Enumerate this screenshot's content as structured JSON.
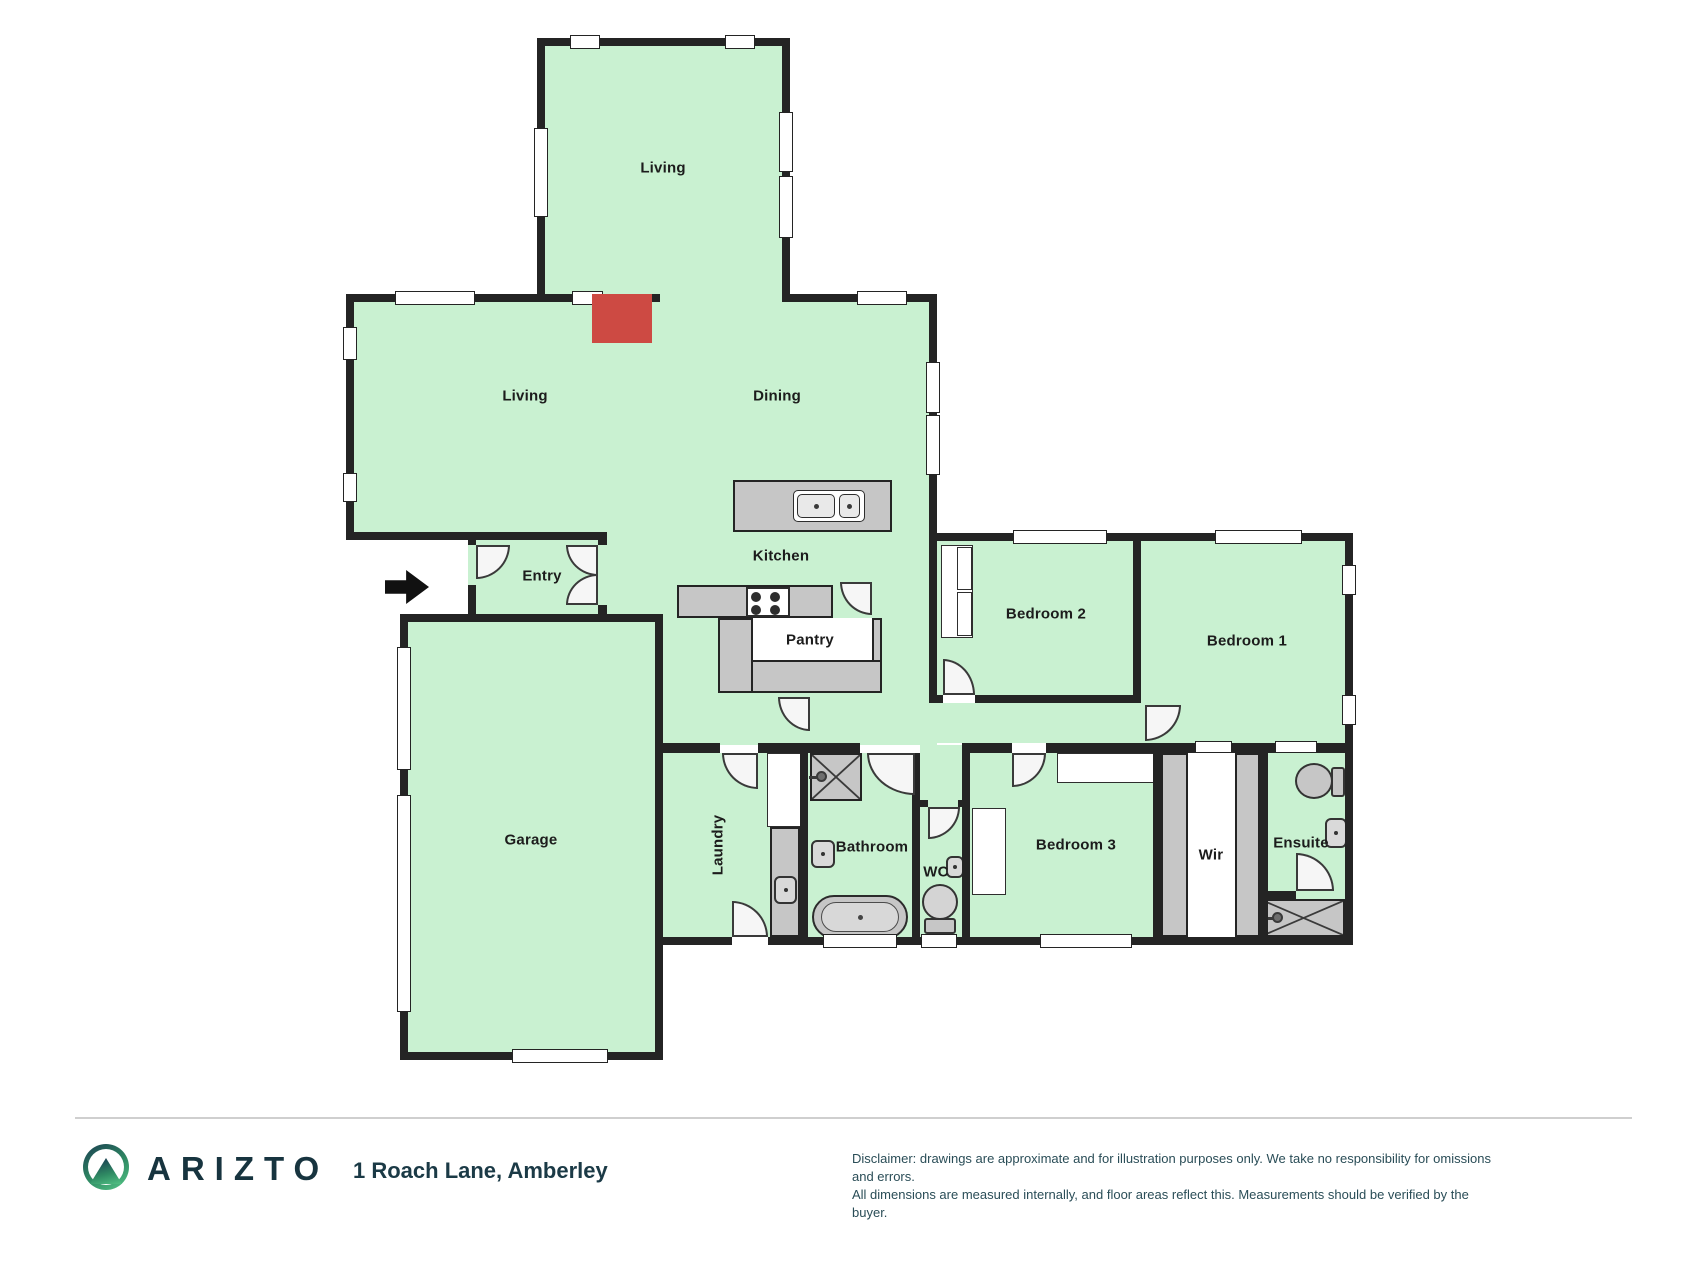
{
  "document": {
    "type": "floor-plan",
    "property_address": "1 Roach Lane, Amberley"
  },
  "floorplan": {
    "rooms": {
      "living_top": {
        "label": "Living"
      },
      "living": {
        "label": "Living"
      },
      "dining": {
        "label": "Dining"
      },
      "kitchen": {
        "label": "Kitchen"
      },
      "pantry": {
        "label": "Pantry"
      },
      "entry": {
        "label": "Entry"
      },
      "garage": {
        "label": "Garage"
      },
      "laundry": {
        "label": "Laundry"
      },
      "bathroom": {
        "label": "Bathroom"
      },
      "wc": {
        "label": "WC"
      },
      "bedroom1": {
        "label": "Bedroom 1"
      },
      "bedroom2": {
        "label": "Bedroom 2"
      },
      "bedroom3": {
        "label": "Bedroom 3"
      },
      "wir": {
        "label": "Wir"
      },
      "ensuite": {
        "label": "Ensuite"
      }
    },
    "fixtures": [
      "fireplace",
      "kitchen-island-double-sink",
      "cooktop",
      "pantry-shelves",
      "entry-direction-arrow",
      "laundry-cabinet",
      "laundry-counter-sink",
      "bathroom-shower",
      "bathroom-sink",
      "freestanding-bathtub",
      "wc-toilet",
      "wc-sink",
      "ensuite-toilet",
      "ensuite-sink",
      "ensuite-shower",
      "bedroom2-wardrobe",
      "bedroom3-wardrobes",
      "walk-in-robe-shelving"
    ],
    "colors": {
      "room_fill": "#c9f1d1",
      "wall": "#242424",
      "fixture_gray": "#c6c6c6",
      "fireplace_red": "#cd4a43",
      "brand_dark": "#17343f",
      "brand_green": "#52c184"
    }
  },
  "footer": {
    "brand": "ARIZTO",
    "address": "1 Roach Lane, Amberley",
    "disclaimer_line1": "Disclaimer: drawings are approximate and for illustration purposes only. We take no responsibility for omissions and errors.",
    "disclaimer_line2": "All dimensions are measured internally, and floor areas reflect this. Measurements should be verified by the buyer."
  }
}
